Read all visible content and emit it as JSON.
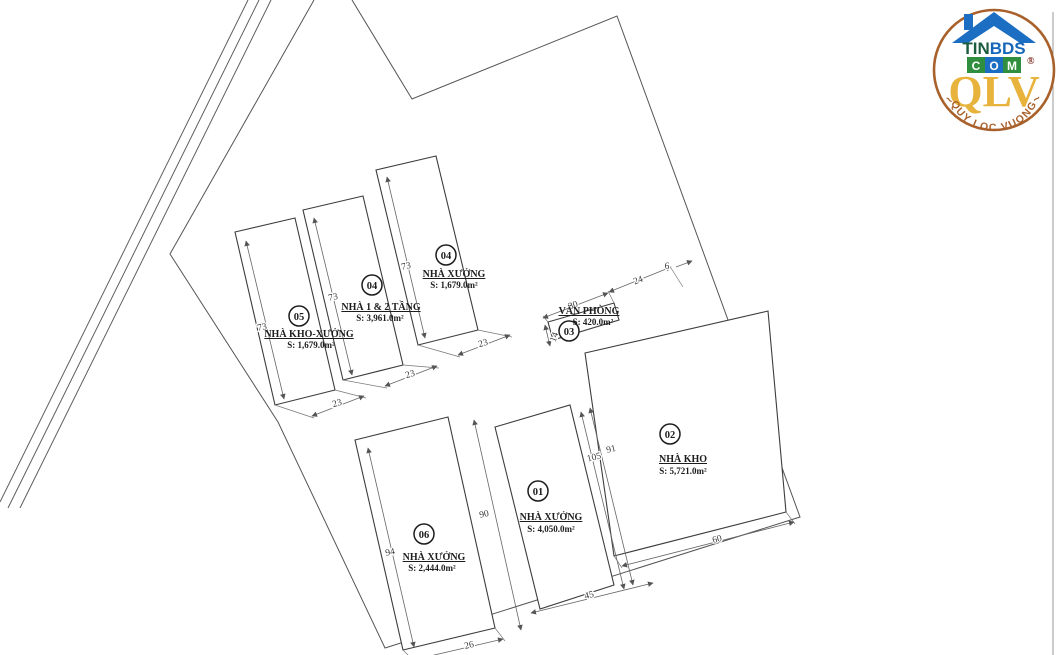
{
  "logo": {
    "brand_green": "TIN",
    "brand_blue": "BDS",
    "com_letters": [
      "C",
      "O",
      "M"
    ],
    "registered": "®",
    "monogram": "QLV",
    "arc_text": "QUY LOC VUONG",
    "colors": {
      "blue": "#1b6ec2",
      "green": "#2f8f3e",
      "gold": "#e8b33c",
      "brown": "#a9612c"
    }
  },
  "plan": {
    "buildings": [
      {
        "num": "01",
        "name": "NHÀ XƯỞNG",
        "area": "S: 4,050.0m²"
      },
      {
        "num": "02",
        "name": "NHÀ KHO",
        "area": "S: 5,721.0m²"
      },
      {
        "num": "03",
        "name": "VĂN PHÒNG",
        "area": "S: 420.0m²"
      },
      {
        "num": "04",
        "name": "NHÀ 1 & 2 TẦNG",
        "area": "S: 3,961.0m²"
      },
      {
        "num": "04",
        "name": "NHÀ XƯỞNG",
        "area": "S: 1,679.0m²"
      },
      {
        "num": "05",
        "name": "NHÀ KHO-XƯỞNG",
        "area": "S: 1,679.0m²"
      },
      {
        "num": "06",
        "name": "NHÀ XƯỞNG",
        "area": "S: 2,444.0m²"
      }
    ],
    "dims": {
      "b05_left": "73",
      "b05_bottom": "23",
      "b04a_left": "73",
      "b04a_bottom": "23",
      "b04b_left": "73",
      "b04b_bottom": "23",
      "b06_left": "94",
      "b06_bottom": "26",
      "b01_left": "90",
      "b01_right": "105",
      "b02_left": "91",
      "b02_bottom": "60",
      "b01_bottom": "45",
      "b03_top": "30",
      "b03_left": "14",
      "b02_top": "24",
      "b02_notch": "6"
    }
  }
}
